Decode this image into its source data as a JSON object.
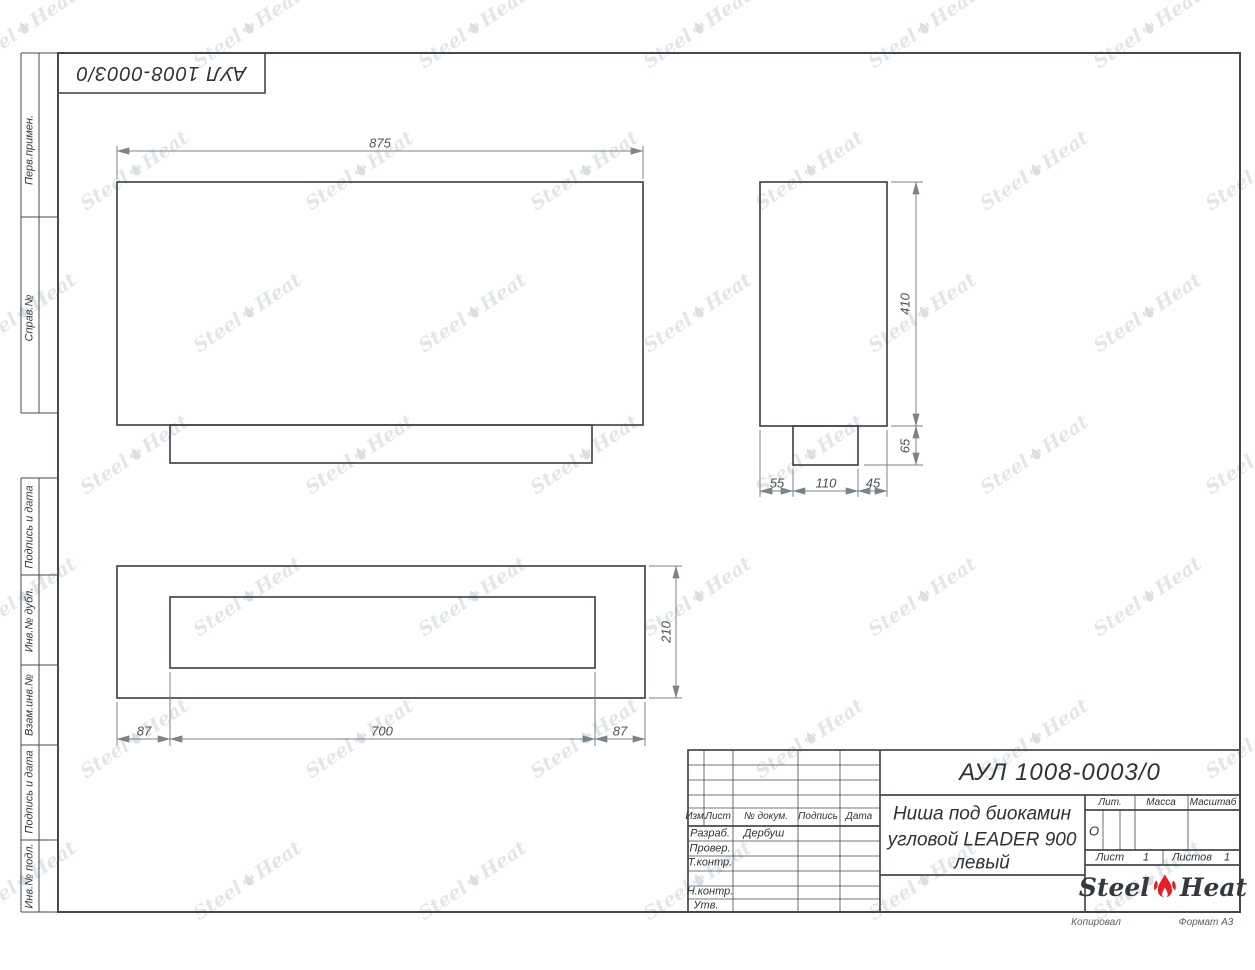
{
  "sheet": {
    "stamp_inverted": "АУЛ 1008-0003/0",
    "side_labels": [
      "Перв.примен.",
      "Справ.№",
      "Подпись и дата",
      "Инв.№ дубл.",
      "Взам.инв.№",
      "Подпись и дата",
      "Инв.№ подл."
    ],
    "footer": {
      "copied": "Копировал",
      "format": "Формат А3"
    }
  },
  "views": {
    "front": {
      "width": "875"
    },
    "side": {
      "height": "410",
      "base_height": "65",
      "bottom": [
        "55",
        "110",
        "45"
      ]
    },
    "top": {
      "left": "87",
      "center": "700",
      "right": "87",
      "depth": "210"
    }
  },
  "title_block": {
    "doc_number": "АУЛ 1008-0003/0",
    "name_line1": "Ниша под биокамин",
    "name_line2": "угловой LEADER 900",
    "name_line3": "левый",
    "cols": {
      "izm": "Изм.",
      "list": "Лист",
      "doc": "№ докум.",
      "sign": "Подпись",
      "date": "Дата"
    },
    "rows": {
      "razrab": "Разраб.",
      "prover": "Провер.",
      "tkontr": "Т.контр.",
      "nkontr": "Н.контр.",
      "utv": "Утв."
    },
    "developer": "Дербуш",
    "lit_label": "Лит.",
    "lit_value": "О",
    "massa_label": "Масса",
    "masshtab_label": "Масштаб",
    "list_label": "Лист",
    "list_value": "1",
    "listov_label": "Листов",
    "listov_value": "1",
    "logo": {
      "word1": "Steel",
      "word2": "Heat"
    }
  },
  "watermark": {
    "word1": "Steel",
    "word2": "Heat"
  },
  "colors": {
    "object_line": "#45494d",
    "dim_line": "#7d8286",
    "flame_red": "#e31e24",
    "watermark": "#e3e6e9"
  }
}
